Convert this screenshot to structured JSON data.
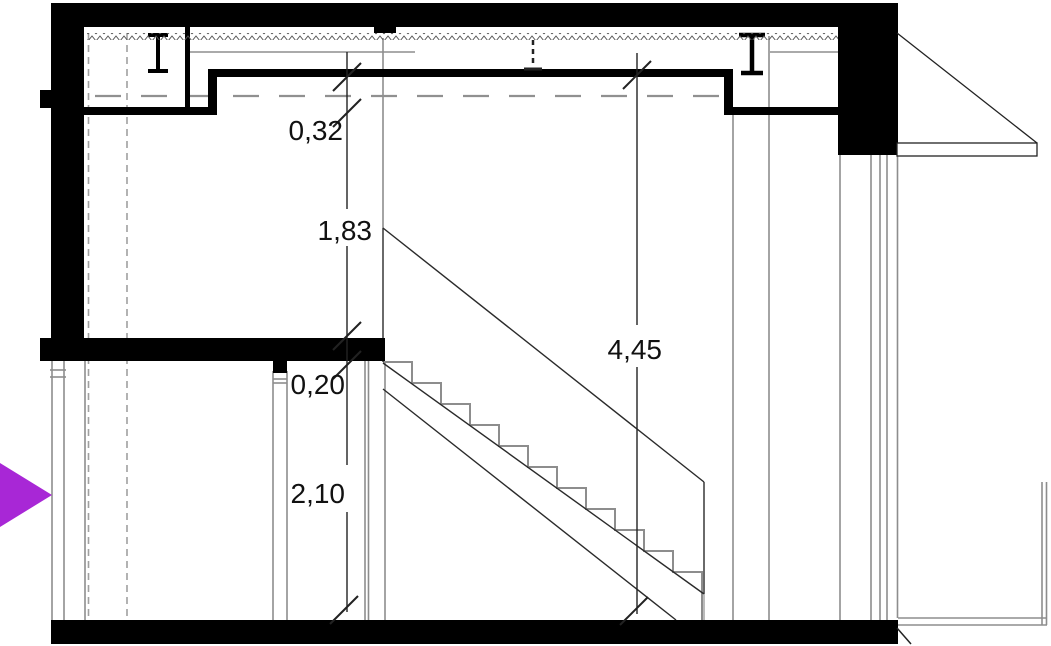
{
  "drawing": {
    "type": "architectural-stair-section",
    "dimension_labels": {
      "ceiling_drop": "0,32",
      "upper_level_height": "1,83",
      "slab_thickness": "0,20",
      "lower_level_height": "2,10",
      "overall_height": "4,45"
    },
    "colors": {
      "ink": "#111111",
      "wall_fill": "#000000",
      "gray_line": "#8d8d8d",
      "dash_line": "#9a9a9a",
      "cursor": "#a827d6"
    }
  }
}
